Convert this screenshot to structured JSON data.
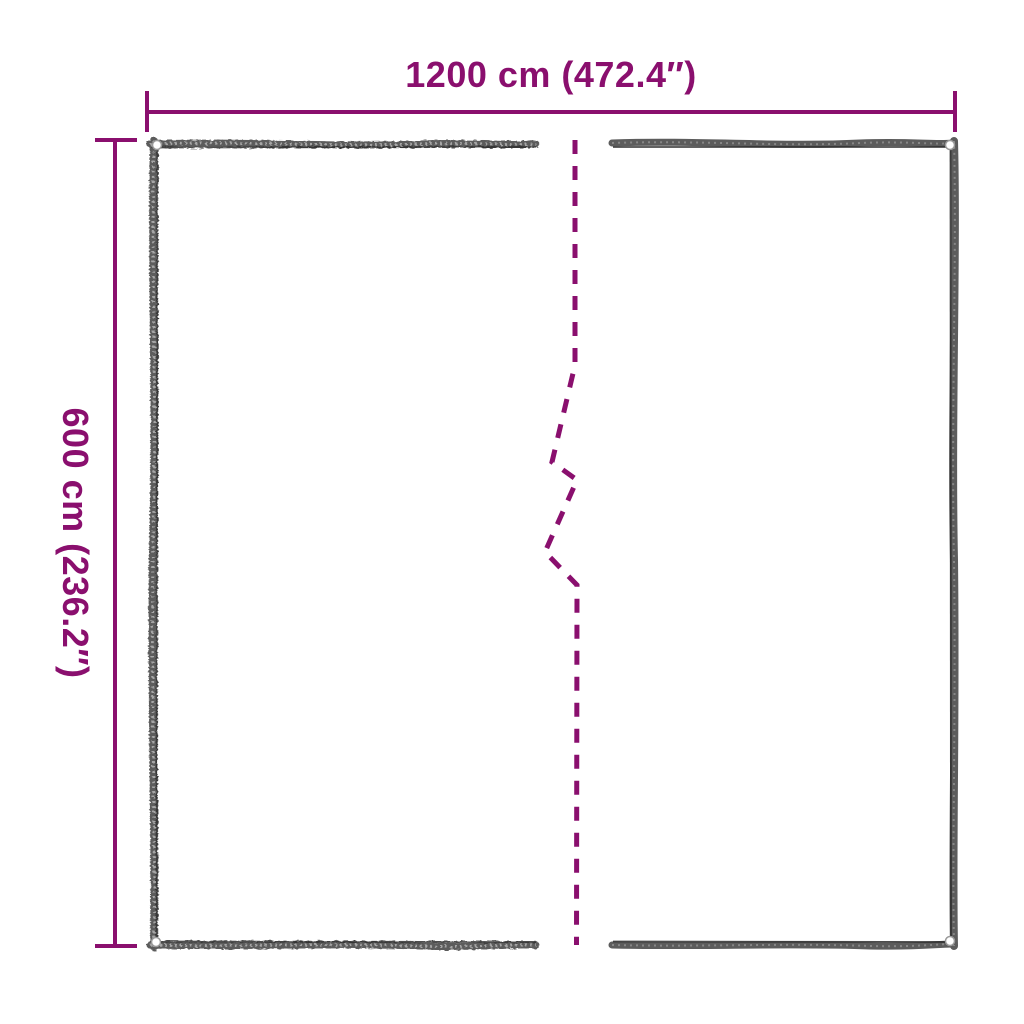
{
  "diagram": {
    "subject": "tarpaulin-dimension-diagram",
    "width_dimension": {
      "label": "1200 cm (472.4″)"
    },
    "height_dimension": {
      "label": "600 cm (236.2″)"
    },
    "colors": {
      "accent": "#8a0f6e",
      "edge": "#5c5c5c",
      "edge_dark": "#2d2d2d",
      "eyelet_fill": "#ffffff",
      "eyelet_ring": "#9a9a9a",
      "background": "#ffffff"
    }
  }
}
